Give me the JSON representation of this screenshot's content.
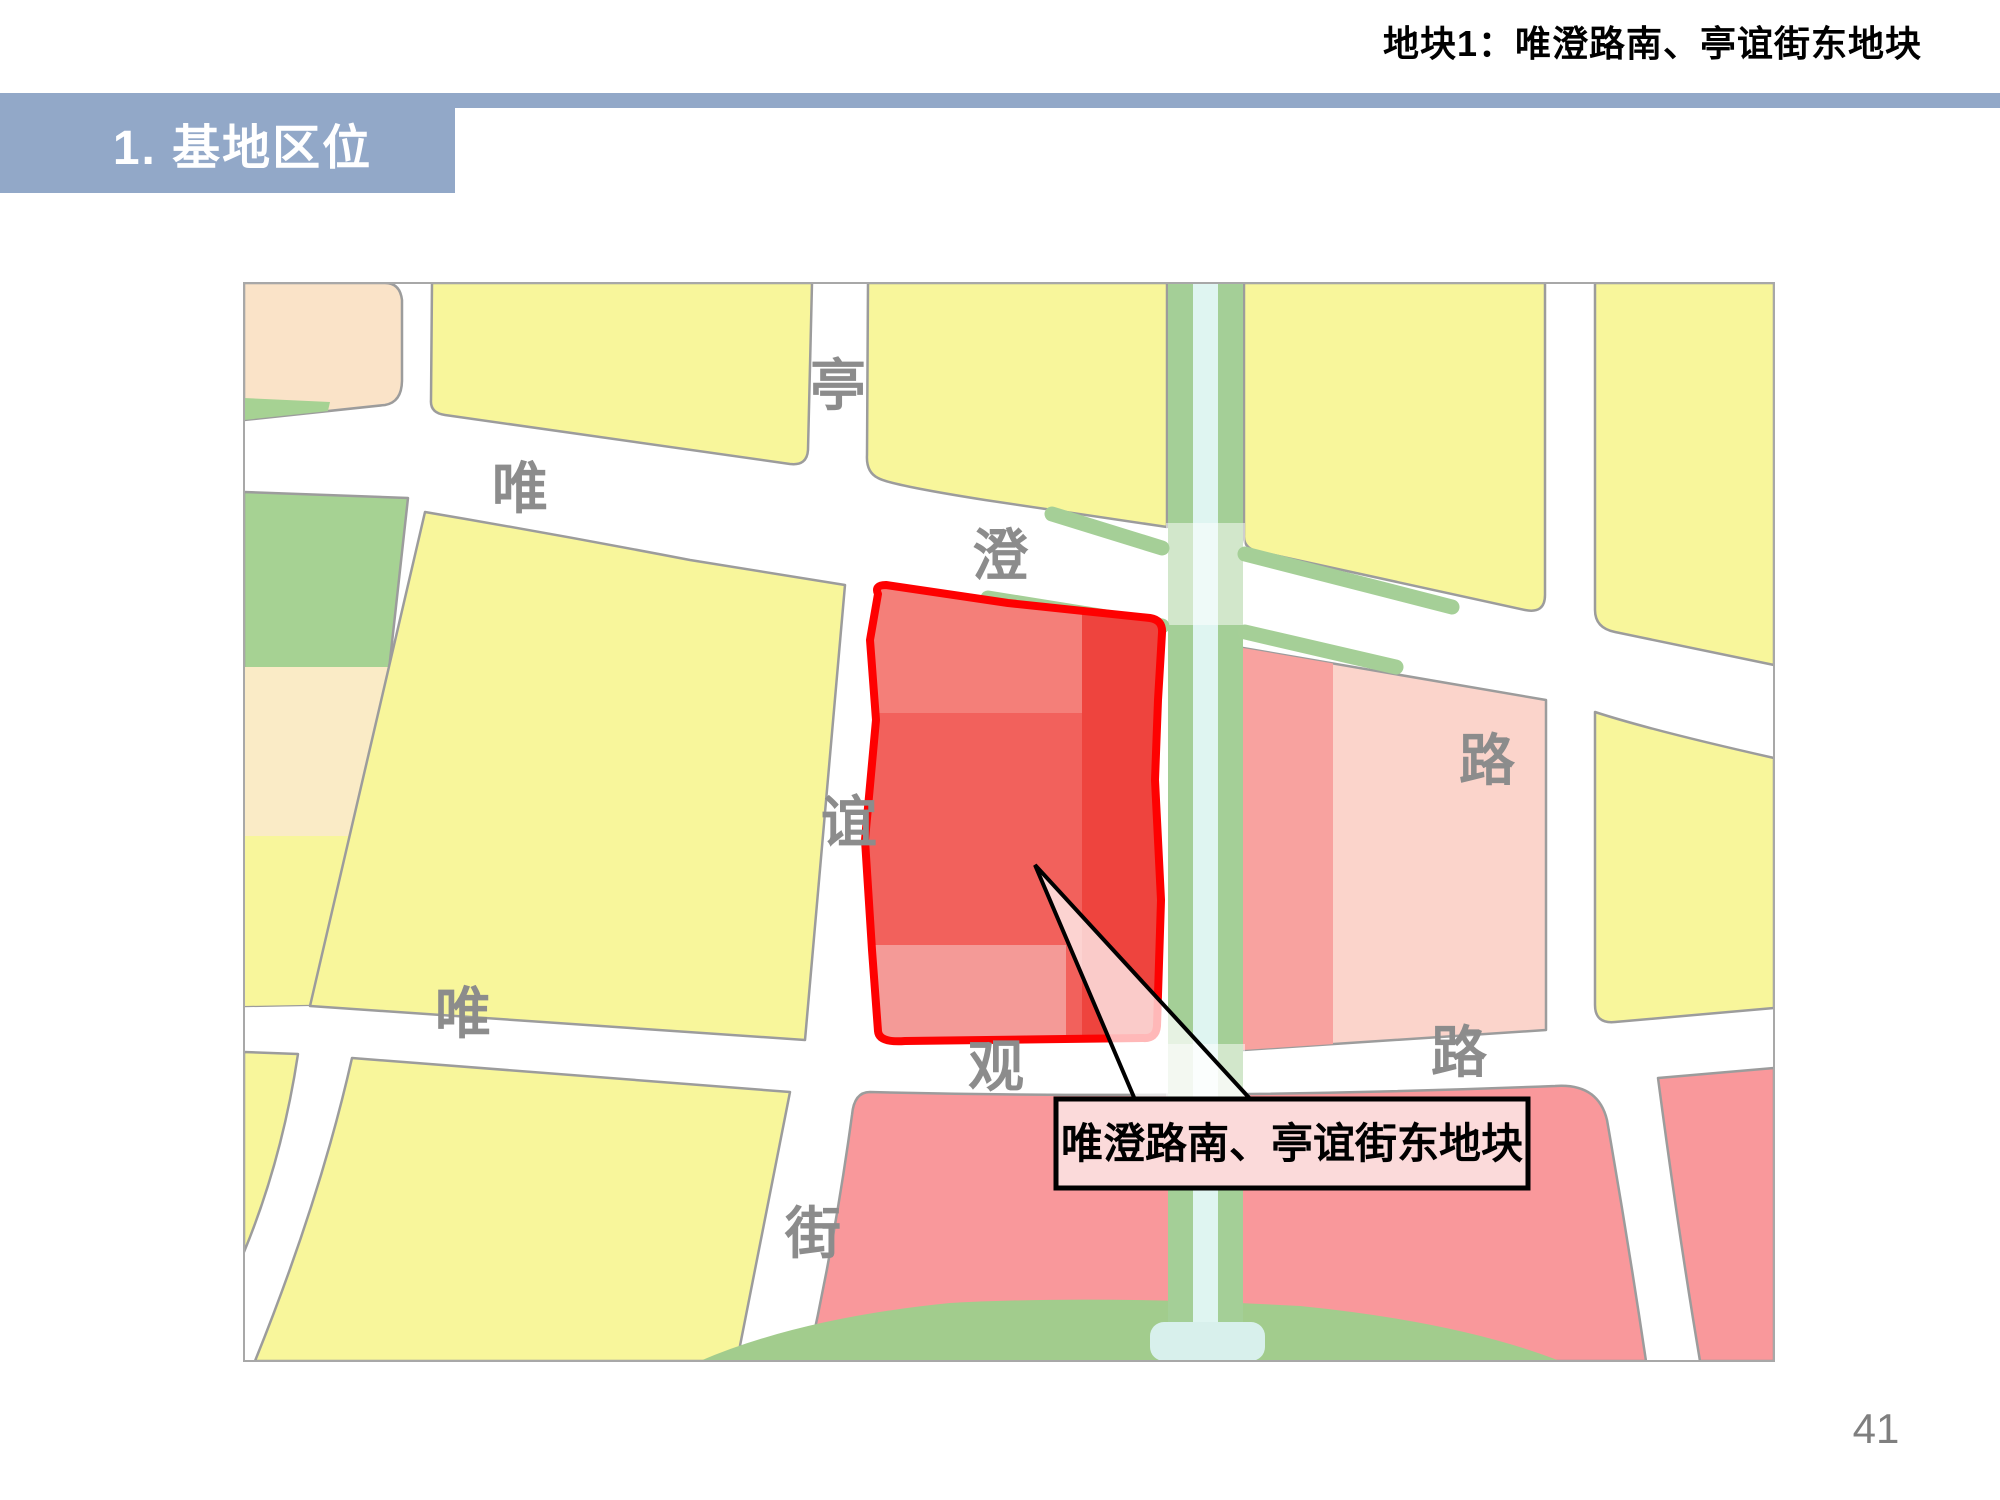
{
  "header": {
    "doc_title": "地块1：唯澄路南、亭谊街东地块",
    "section_title": "1. 基地区位"
  },
  "map": {
    "road_labels": [
      {
        "char": "亭"
      },
      {
        "char": "唯"
      },
      {
        "char": "澄"
      },
      {
        "char": "路"
      },
      {
        "char": "谊"
      },
      {
        "char": "唯"
      },
      {
        "char": "观"
      },
      {
        "char": "路"
      },
      {
        "char": "街"
      }
    ],
    "callout": {
      "text": "唯澄路南、亭谊街东地块"
    },
    "colors": {
      "banner_blue": "#92A8C8",
      "parcel_yellow": "#F8F69B",
      "parcel_peach": "#FAE3C8",
      "parcel_green": "#A6D293",
      "parcel_cream": "#FAEBC6",
      "parcel_salmon": "#F9989B",
      "parcel_pink_medium": "#F8A29F",
      "parcel_pink_light": "#FBD4CB",
      "canal_bank_green": "#A4CF97",
      "canal_water": "#DFF5F1",
      "park_green": "#A2CC8D",
      "site_red_main": "#F2615C",
      "site_red_top": "#F47F79",
      "site_red_right": "#EE443E",
      "site_red_bottom": "#F49A97",
      "site_outline_red": "#FE0101",
      "callout_box_fill": "#FBDADA",
      "road_label_gray": "#8C8C8C"
    }
  },
  "footer": {
    "page_number": "41"
  }
}
